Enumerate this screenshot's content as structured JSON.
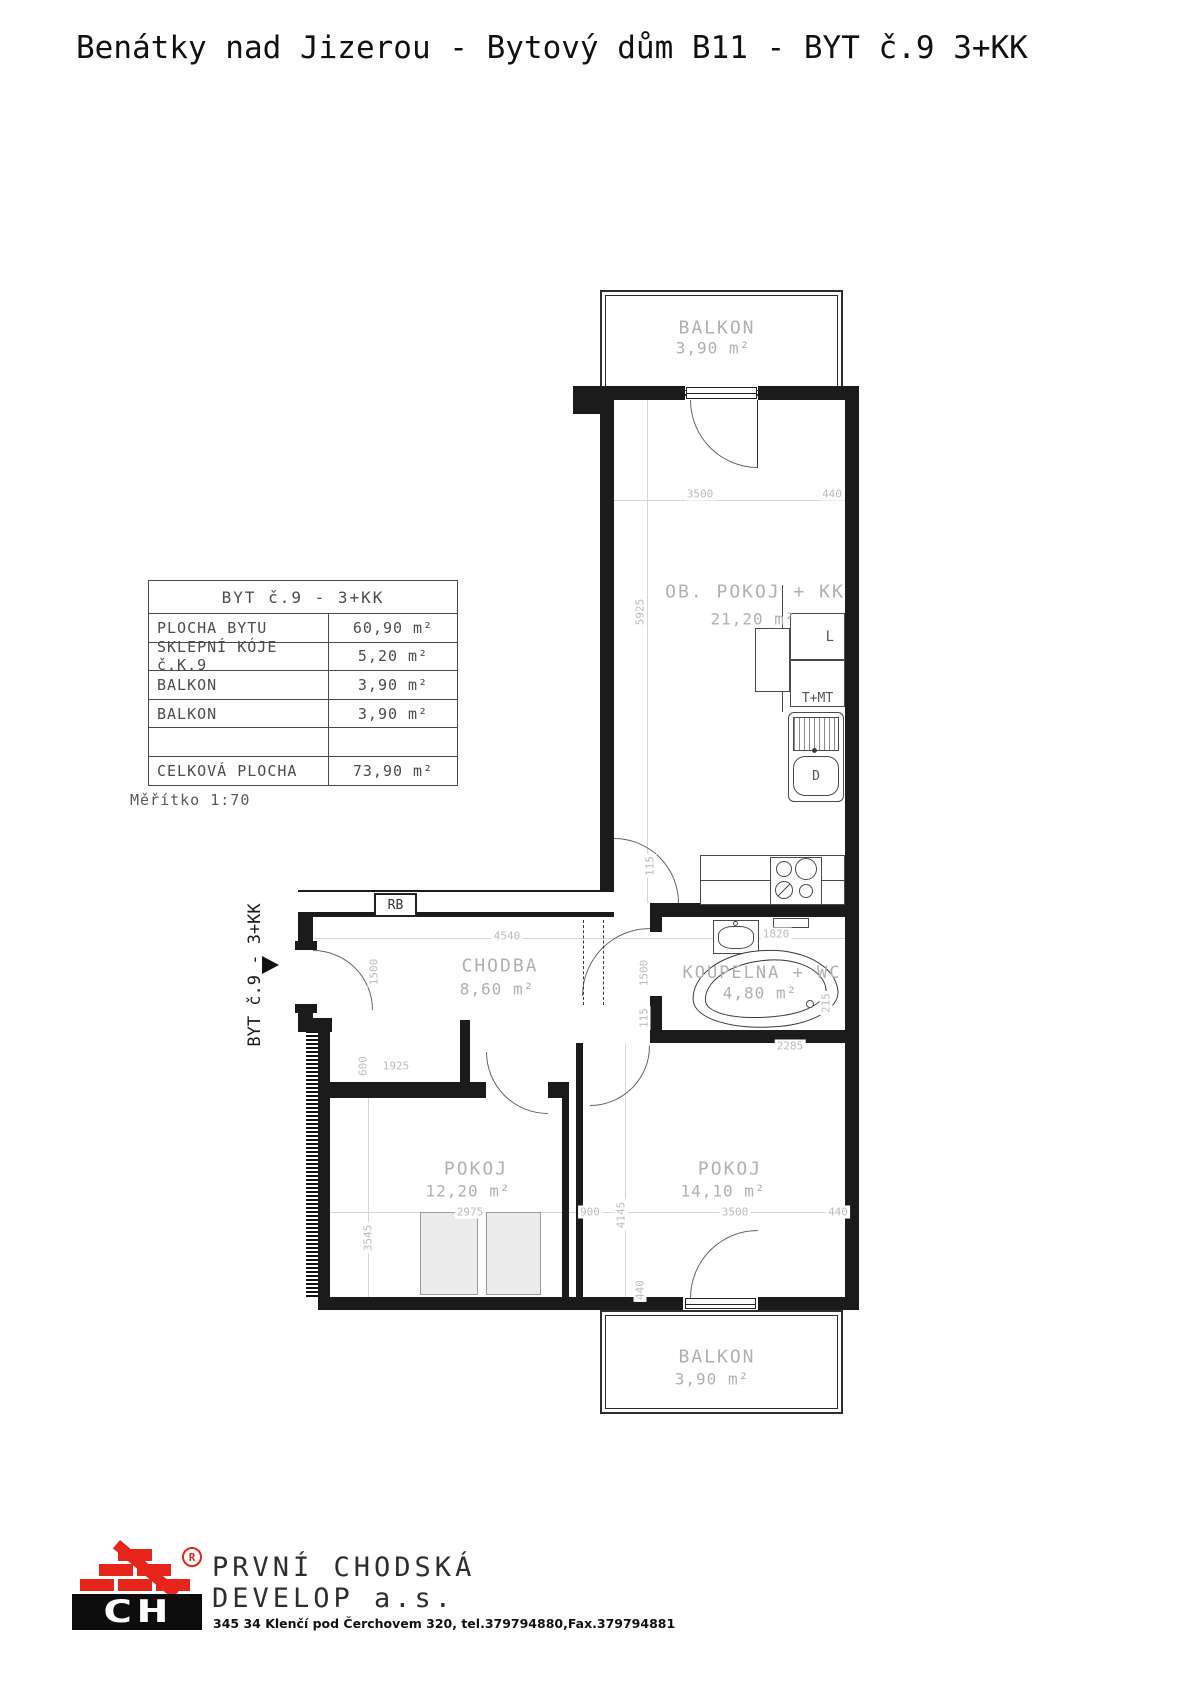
{
  "title": "Benátky nad Jizerou - Bytový dům B11 - BYT č.9 3+KK",
  "scale_note": "Měřítko 1:70",
  "side_label": "BYT č.9 - 3+KK",
  "table": {
    "header": "BYT č.9 - 3+KK",
    "rows": [
      {
        "label": "PLOCHA BYTU",
        "value": "60,90 m²"
      },
      {
        "label": "SKLEPNÍ KÓJE č.K.9",
        "value": "5,20 m²"
      },
      {
        "label": "BALKON",
        "value": "3,90 m²"
      },
      {
        "label": "BALKON",
        "value": "3,90 m²"
      },
      {
        "label": "",
        "value": ""
      },
      {
        "label": "CELKOVÁ PLOCHA",
        "value": "73,90 m²"
      }
    ]
  },
  "rooms": {
    "balkon_top": {
      "name": "BALKON",
      "area": "3,90 m²"
    },
    "obyvaci": {
      "name": "OB. POKOJ + KK",
      "area": "21,20 m²"
    },
    "chodba": {
      "name": "CHODBA",
      "area": "8,60 m²"
    },
    "koupelna": {
      "name": "KOUPELNA + WC",
      "area": "4,80 m²"
    },
    "pokoj1": {
      "name": "POKOJ",
      "area": "12,20 m²"
    },
    "pokoj2": {
      "name": "POKOJ",
      "area": "14,10 m²"
    },
    "balkon_bottom": {
      "name": "BALKON",
      "area": "3,90 m²"
    }
  },
  "fixtures": {
    "fridge": "L",
    "oven_micro": "T+MT",
    "sink": "D",
    "switchboard": "RB"
  },
  "dims": {
    "t3500": "3500",
    "t440": "440",
    "v5925": "5925",
    "v115a": "115",
    "c4540": "4540",
    "k1820": "1820",
    "v1500a": "1500",
    "v1500b": "1500",
    "v115b": "115",
    "v215": "215",
    "k2285": "2285",
    "n600": "600",
    "n1925": "1925",
    "p3545": "3545",
    "p4145": "4145",
    "b2975": "2975",
    "b900": "900",
    "b3500": "3500",
    "b440": "440",
    "v440": "440"
  },
  "logo": {
    "company_line1": "PRVNÍ CHODSKÁ",
    "company_line2": "DEVELOP a.s.",
    "monogram": "CH",
    "registered": "®",
    "address": "345 34 Klenčí pod Čerchovem 320,  tel.379794880,Fax.379794881"
  },
  "colors": {
    "brand_red": "#e8251a",
    "wall_black": "#1b1b1b",
    "label_gray": "#b0b0b0",
    "dim_gray": "#bcbcbc"
  }
}
